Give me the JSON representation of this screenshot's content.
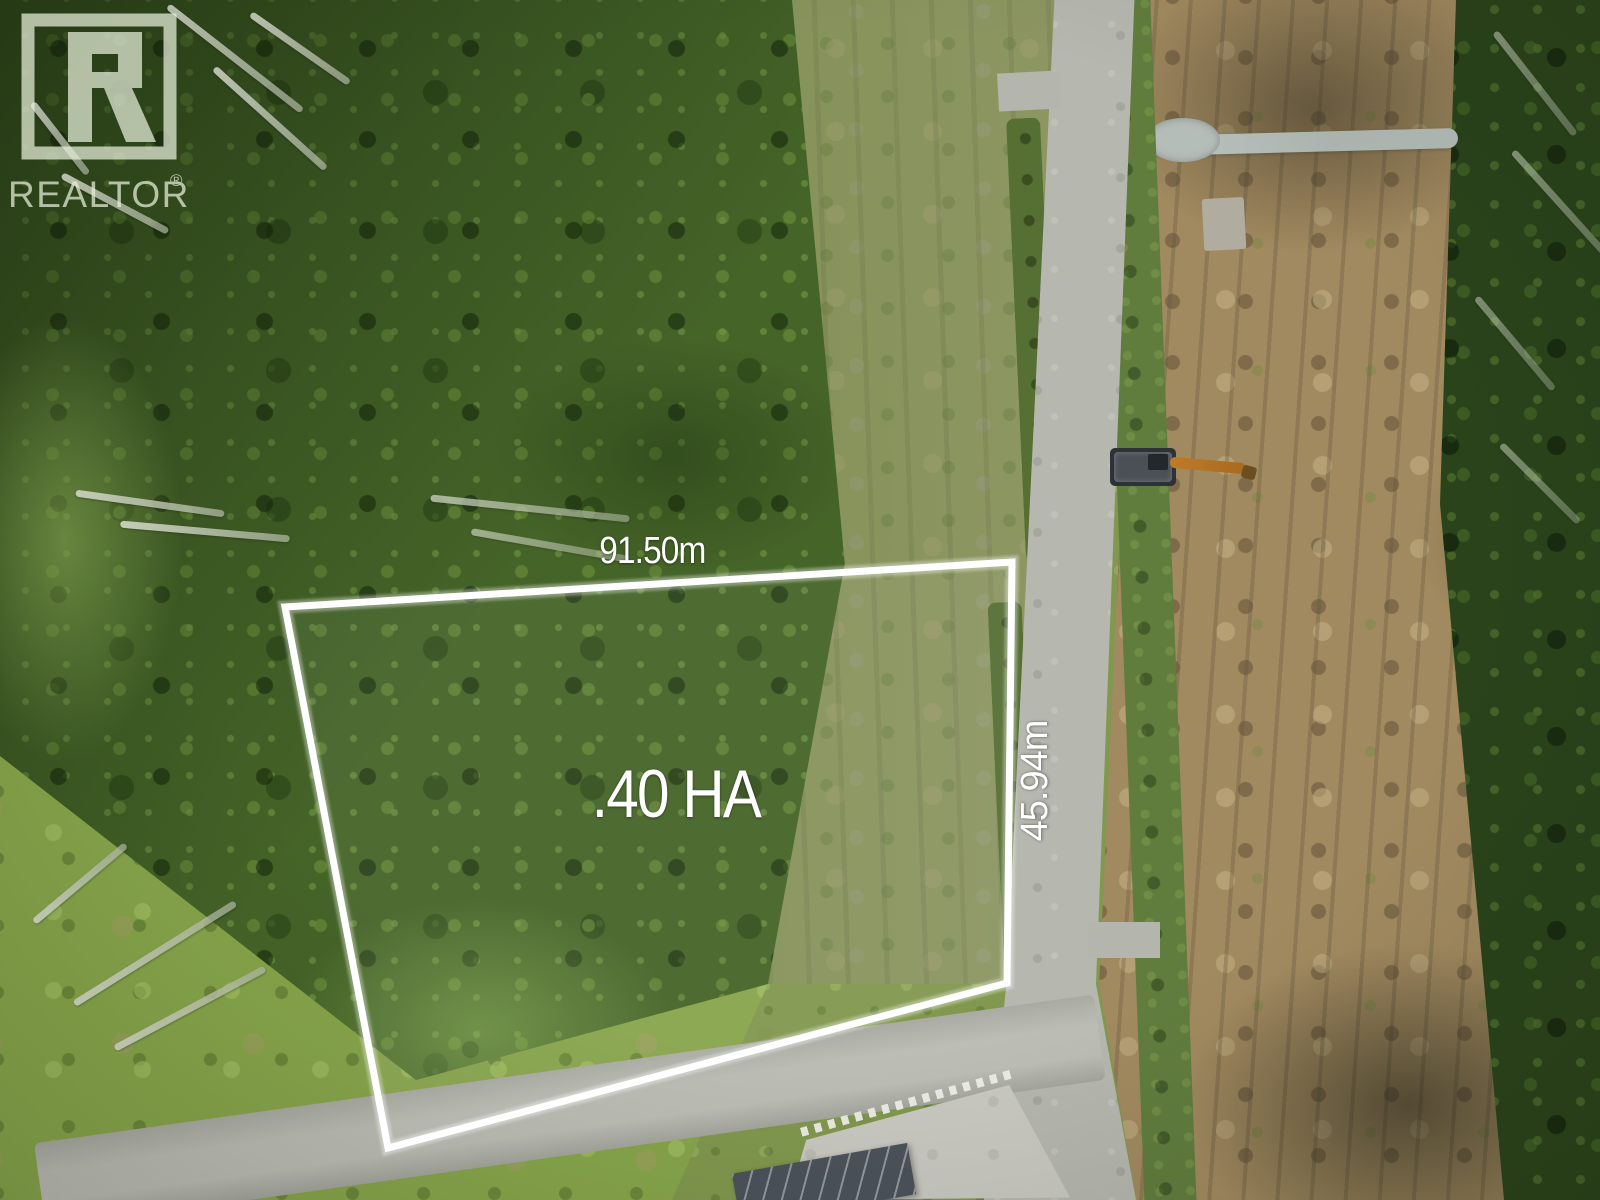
{
  "annotations": {
    "width_label": "91.50m",
    "depth_label": "45.94m",
    "area_label": ".40 HA"
  },
  "watermark": {
    "brand_text": "REALTOR",
    "registered_symbol": "®",
    "logo_letter": "R"
  },
  "lot_outline": {
    "points": "285,607 1012,562 1007,983 388,1148",
    "stroke_color": "#ffffff"
  },
  "palette": {
    "forest_green": "#456428",
    "right_forest_green": "#2a431b",
    "meadow_green": "#87a54b",
    "scrub_olive": "#87945a",
    "road_gray": "#b6b7af",
    "dirt_brown": "#a28a60",
    "annotation_white": "#ffffff",
    "watermark_tint": "#e9f1dc",
    "excavator_orange": "#c07a28"
  }
}
